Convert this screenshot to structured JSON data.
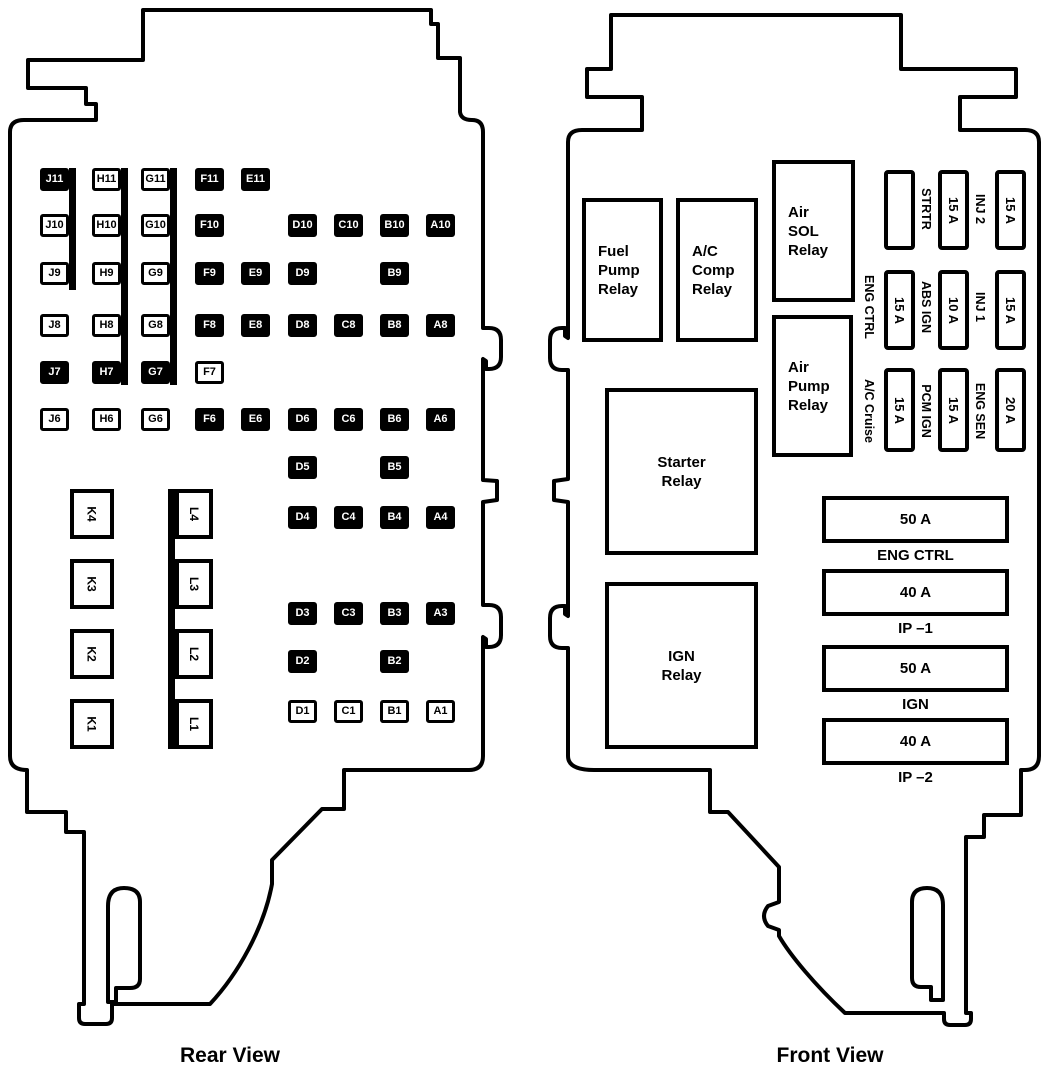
{
  "captions": {
    "rear": "Rear View",
    "front": "Front View"
  },
  "colors": {
    "ink": "#000000",
    "paper": "#ffffff"
  },
  "rear_view": {
    "cells": [
      {
        "id": "J11",
        "col": "J",
        "row": 11,
        "dark": true
      },
      {
        "id": "H11",
        "col": "H",
        "row": 11,
        "dark": false
      },
      {
        "id": "G11",
        "col": "G",
        "row": 11,
        "dark": false
      },
      {
        "id": "F11",
        "col": "F",
        "row": 11,
        "dark": true
      },
      {
        "id": "E11",
        "col": "E",
        "row": 11,
        "dark": true
      },
      {
        "id": "J10",
        "col": "J",
        "row": 10,
        "dark": false
      },
      {
        "id": "H10",
        "col": "H",
        "row": 10,
        "dark": false
      },
      {
        "id": "G10",
        "col": "G",
        "row": 10,
        "dark": false
      },
      {
        "id": "F10",
        "col": "F",
        "row": 10,
        "dark": true
      },
      {
        "id": "D10",
        "col": "D",
        "row": 10,
        "dark": true
      },
      {
        "id": "C10",
        "col": "C",
        "row": 10,
        "dark": true
      },
      {
        "id": "B10",
        "col": "B",
        "row": 10,
        "dark": true
      },
      {
        "id": "A10",
        "col": "A",
        "row": 10,
        "dark": true
      },
      {
        "id": "J9",
        "col": "J",
        "row": 9,
        "dark": false
      },
      {
        "id": "H9",
        "col": "H",
        "row": 9,
        "dark": false
      },
      {
        "id": "G9",
        "col": "G",
        "row": 9,
        "dark": false
      },
      {
        "id": "F9",
        "col": "F",
        "row": 9,
        "dark": true
      },
      {
        "id": "E9",
        "col": "E",
        "row": 9,
        "dark": true
      },
      {
        "id": "D9",
        "col": "D",
        "row": 9,
        "dark": true
      },
      {
        "id": "B9",
        "col": "B",
        "row": 9,
        "dark": true
      },
      {
        "id": "J8",
        "col": "J",
        "row": 8,
        "dark": false
      },
      {
        "id": "H8",
        "col": "H",
        "row": 8,
        "dark": false
      },
      {
        "id": "G8",
        "col": "G",
        "row": 8,
        "dark": false
      },
      {
        "id": "F8",
        "col": "F",
        "row": 8,
        "dark": true
      },
      {
        "id": "E8",
        "col": "E",
        "row": 8,
        "dark": true
      },
      {
        "id": "D8",
        "col": "D",
        "row": 8,
        "dark": true
      },
      {
        "id": "C8",
        "col": "C",
        "row": 8,
        "dark": true
      },
      {
        "id": "B8",
        "col": "B",
        "row": 8,
        "dark": true
      },
      {
        "id": "A8",
        "col": "A",
        "row": 8,
        "dark": true
      },
      {
        "id": "J7",
        "col": "J",
        "row": 7,
        "dark": true
      },
      {
        "id": "H7",
        "col": "H",
        "row": 7,
        "dark": true
      },
      {
        "id": "G7",
        "col": "G",
        "row": 7,
        "dark": true
      },
      {
        "id": "F7",
        "col": "F",
        "row": 7,
        "dark": false
      },
      {
        "id": "J6",
        "col": "J",
        "row": 6,
        "dark": false
      },
      {
        "id": "H6",
        "col": "H",
        "row": 6,
        "dark": false
      },
      {
        "id": "G6",
        "col": "G",
        "row": 6,
        "dark": false
      },
      {
        "id": "F6",
        "col": "F",
        "row": 6,
        "dark": true
      },
      {
        "id": "E6",
        "col": "E",
        "row": 6,
        "dark": true
      },
      {
        "id": "D6",
        "col": "D",
        "row": 6,
        "dark": true
      },
      {
        "id": "C6",
        "col": "C",
        "row": 6,
        "dark": true
      },
      {
        "id": "B6",
        "col": "B",
        "row": 6,
        "dark": true
      },
      {
        "id": "A6",
        "col": "A",
        "row": 6,
        "dark": true
      },
      {
        "id": "D5",
        "col": "D",
        "row": 5,
        "dark": true
      },
      {
        "id": "B5",
        "col": "B",
        "row": 5,
        "dark": true
      },
      {
        "id": "D4",
        "col": "D",
        "row": 4,
        "dark": true
      },
      {
        "id": "C4",
        "col": "C",
        "row": 4,
        "dark": true
      },
      {
        "id": "B4",
        "col": "B",
        "row": 4,
        "dark": true
      },
      {
        "id": "A4",
        "col": "A",
        "row": 4,
        "dark": true
      },
      {
        "id": "D3",
        "col": "D",
        "row": 3,
        "dark": true
      },
      {
        "id": "C3",
        "col": "C",
        "row": 3,
        "dark": true
      },
      {
        "id": "B3",
        "col": "B",
        "row": 3,
        "dark": true
      },
      {
        "id": "A3",
        "col": "A",
        "row": 3,
        "dark": true
      },
      {
        "id": "D2",
        "col": "D",
        "row": 2,
        "dark": true
      },
      {
        "id": "B2",
        "col": "B",
        "row": 2,
        "dark": true
      },
      {
        "id": "D1",
        "col": "D",
        "row": 1,
        "dark": false
      },
      {
        "id": "C1",
        "col": "C",
        "row": 1,
        "dark": false
      },
      {
        "id": "B1",
        "col": "B",
        "row": 1,
        "dark": false
      },
      {
        "id": "A1",
        "col": "A",
        "row": 1,
        "dark": false
      }
    ],
    "relay_blocks": [
      {
        "id": "K4",
        "col": "K",
        "slot": 4
      },
      {
        "id": "K3",
        "col": "K",
        "slot": 3
      },
      {
        "id": "K2",
        "col": "K",
        "slot": 2
      },
      {
        "id": "K1",
        "col": "K",
        "slot": 1
      },
      {
        "id": "L4",
        "col": "L",
        "slot": 4
      },
      {
        "id": "L3",
        "col": "L",
        "slot": 3
      },
      {
        "id": "L2",
        "col": "L",
        "slot": 2
      },
      {
        "id": "L1",
        "col": "L",
        "slot": 1
      }
    ]
  },
  "front_view": {
    "relays": [
      {
        "id": "fuel-pump",
        "lines": [
          "Fuel",
          "Pump",
          "Relay"
        ],
        "align": "pad"
      },
      {
        "id": "ac-comp",
        "lines": [
          "A/C",
          "Comp",
          "Relay"
        ],
        "align": "pad"
      },
      {
        "id": "air-sol",
        "lines": [
          "Air",
          "SOL",
          "Relay"
        ],
        "align": "pad"
      },
      {
        "id": "air-pump",
        "lines": [
          "Air",
          "Pump",
          "Relay"
        ],
        "align": "pad"
      },
      {
        "id": "starter",
        "lines": [
          "Starter",
          "Relay"
        ],
        "align": "ctr"
      },
      {
        "id": "ign",
        "lines": [
          "IGN",
          "Relay"
        ],
        "align": "ctr"
      }
    ],
    "mini_fuses": [
      {
        "col": 1,
        "row": 1,
        "amps": "",
        "label_right": "STRTR"
      },
      {
        "col": 2,
        "row": 1,
        "amps": "15 A",
        "label_right": "INJ 2"
      },
      {
        "col": 3,
        "row": 1,
        "amps": "15 A"
      },
      {
        "col": 1,
        "row": 2,
        "amps": "15 A",
        "label_right": "ABS IGN",
        "label_left": "ENG CTRL"
      },
      {
        "col": 2,
        "row": 2,
        "amps": "10 A",
        "label_right": "INJ 1"
      },
      {
        "col": 3,
        "row": 2,
        "amps": "15 A"
      },
      {
        "col": 1,
        "row": 3,
        "amps": "15 A",
        "label_right": "PCM IGN",
        "label_left": "A/C Cruise"
      },
      {
        "col": 2,
        "row": 3,
        "amps": "15 A",
        "label_right": "ENG SEN"
      },
      {
        "col": 3,
        "row": 3,
        "amps": "20 A"
      }
    ],
    "maxi_fuses": [
      {
        "amps": "50 A",
        "label": "ENG CTRL"
      },
      {
        "amps": "40 A",
        "label": "IP –1"
      },
      {
        "amps": "50 A",
        "label": "IGN"
      },
      {
        "amps": "40 A",
        "label": "IP –2"
      }
    ]
  }
}
